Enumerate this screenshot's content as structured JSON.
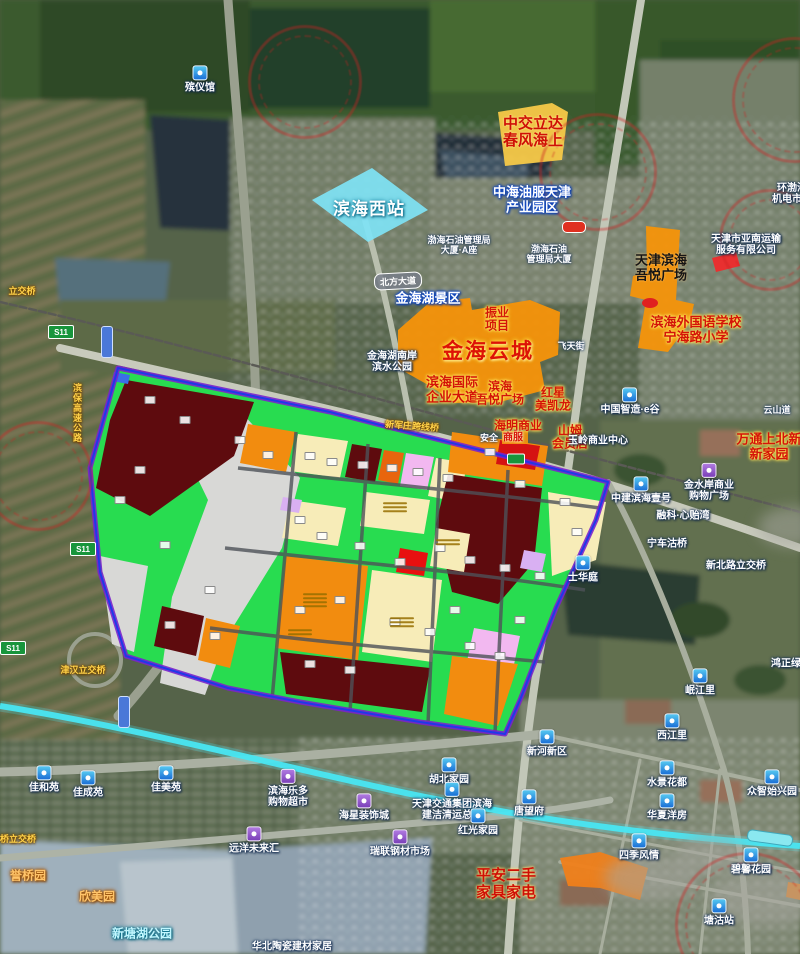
{
  "map": {
    "region_name": "天津滨海新区 金海云城周边卫星规划图",
    "colors": {
      "zone_maroon": "#5E0B0E",
      "zone_green": "#28DC50",
      "zone_orange": "#F28C0F",
      "zone_cream": "#F7ECB8",
      "zone_pink": "#F2B8F0",
      "zone_red": "#E01212",
      "zone_gray": "#D8D8D6",
      "boundary_purple": "#7A22CC",
      "boundary_blue": "#2038E8",
      "landmark_orange": "#F5930A",
      "station_cyan": "#7FE3F5",
      "water_cyan": "#49E6F2",
      "highlight_yellow": "#F7C948",
      "watermark_red": "#CD2323"
    },
    "labels": [
      {
        "t": "殡仪馆",
        "x": 200,
        "y": 88,
        "s": "s-white-sm",
        "i": "blue"
      },
      {
        "t": "中交立达\n春风海上",
        "x": 533,
        "y": 133,
        "s": "s-red-lg"
      },
      {
        "t": "滨海西站",
        "x": 369,
        "y": 209,
        "s": "s-station"
      },
      {
        "t": "中海油服天津\n产业园区",
        "x": 532,
        "y": 200,
        "s": "s-blueoutline"
      },
      {
        "t": "渤海石油管理局\n大厦·A座",
        "x": 459,
        "y": 245,
        "s": "s-white-xs"
      },
      {
        "t": "渤海石油\n管理局大厦",
        "x": 549,
        "y": 254,
        "s": "s-white-xs"
      },
      {
        "t": "天津滨海\n吾悦广场",
        "x": 661,
        "y": 268,
        "s": "s-black"
      },
      {
        "t": "天津市亚南运输\n服务有限公司",
        "x": 746,
        "y": 245,
        "s": "s-white-sm"
      },
      {
        "t": "环渤海\n机电市场",
        "x": 792,
        "y": 194,
        "s": "s-white-sm"
      },
      {
        "t": "滨海外国语学校\n宁海路小学",
        "x": 696,
        "y": 330,
        "s": "s-redglow-lg"
      },
      {
        "t": "金海湖景区",
        "x": 428,
        "y": 299,
        "s": "s-blueoutline"
      },
      {
        "t": "金海湖南岸\n滨水公园",
        "x": 392,
        "y": 362,
        "s": "s-white-sm"
      },
      {
        "t": "振业\n项目",
        "x": 497,
        "y": 320,
        "s": "s-redglow"
      },
      {
        "t": "金海云城",
        "x": 488,
        "y": 352,
        "s": "s-bigred"
      },
      {
        "t": "飞天街",
        "x": 571,
        "y": 346,
        "s": "s-white-xs"
      },
      {
        "t": "滨海国际\n企业大道",
        "x": 452,
        "y": 390,
        "s": "s-redglow-lg"
      },
      {
        "t": "滨海\n吾悦广场",
        "x": 500,
        "y": 394,
        "s": "s-redglow"
      },
      {
        "t": "红星\n美凯龙",
        "x": 553,
        "y": 400,
        "s": "s-redglow"
      },
      {
        "t": "海明商业",
        "x": 518,
        "y": 426,
        "s": "s-redglow"
      },
      {
        "t": "安全",
        "x": 489,
        "y": 438,
        "s": "s-white-xs"
      },
      {
        "t": "商服",
        "x": 513,
        "y": 438,
        "s": "s-red"
      },
      {
        "t": "山姆\n会员店",
        "x": 570,
        "y": 438,
        "s": "s-redglow"
      },
      {
        "t": "玉岭商业中心",
        "x": 598,
        "y": 441,
        "s": "s-white-sm"
      },
      {
        "t": "中国智造·e谷",
        "x": 630,
        "y": 410,
        "s": "s-white-sm",
        "i": "blue"
      },
      {
        "t": "云山道",
        "x": 777,
        "y": 410,
        "s": "s-white-xs"
      },
      {
        "t": "万通上北新\n新家园",
        "x": 769,
        "y": 447,
        "s": "s-redglow-lg"
      },
      {
        "t": "金水岸商业\n购物广场",
        "x": 709,
        "y": 491,
        "s": "s-white-sm",
        "i": "purple"
      },
      {
        "t": "中建滨海壹号",
        "x": 641,
        "y": 499,
        "s": "s-white-sm",
        "i": "blue"
      },
      {
        "t": "融科·心贻湾",
        "x": 683,
        "y": 516,
        "s": "s-white-sm"
      },
      {
        "t": "宁车沽桥",
        "x": 667,
        "y": 544,
        "s": "s-white-sm"
      },
      {
        "t": "新北路立交桥",
        "x": 736,
        "y": 566,
        "s": "s-white-sm"
      },
      {
        "t": "士华庭",
        "x": 583,
        "y": 578,
        "s": "s-white-sm",
        "i": "blue"
      },
      {
        "t": "鸿正绿色",
        "x": 791,
        "y": 664,
        "s": "s-white-sm"
      },
      {
        "t": "岷江里",
        "x": 700,
        "y": 691,
        "s": "s-white-sm",
        "i": "blue"
      },
      {
        "t": "西江里",
        "x": 672,
        "y": 736,
        "s": "s-white-sm",
        "i": "blue"
      },
      {
        "t": "新河新区",
        "x": 547,
        "y": 752,
        "s": "s-white-sm",
        "i": "blue"
      },
      {
        "t": "胡北家园",
        "x": 449,
        "y": 780,
        "s": "s-white-sm",
        "i": "blue"
      },
      {
        "t": "水景花都",
        "x": 667,
        "y": 783,
        "s": "s-white-sm",
        "i": "blue"
      },
      {
        "t": "众智始兴园",
        "x": 772,
        "y": 792,
        "s": "s-white-sm",
        "i": "blue"
      },
      {
        "t": "唐望府",
        "x": 529,
        "y": 812,
        "s": "s-white-sm",
        "i": "blue"
      },
      {
        "t": "华夏洋房",
        "x": 667,
        "y": 816,
        "s": "s-white-sm",
        "i": "blue"
      },
      {
        "t": "四季风情",
        "x": 639,
        "y": 856,
        "s": "s-white-sm",
        "i": "blue"
      },
      {
        "t": "碧馨花园",
        "x": 751,
        "y": 870,
        "s": "s-white-sm",
        "i": "blue"
      },
      {
        "t": "塘沽站",
        "x": 719,
        "y": 921,
        "s": "s-white-sm",
        "i": "blue"
      },
      {
        "t": "滨海乐多\n购物超市",
        "x": 288,
        "y": 797,
        "s": "s-white-sm",
        "i": "purple"
      },
      {
        "t": "海星装饰城",
        "x": 364,
        "y": 816,
        "s": "s-white-sm",
        "i": "purple"
      },
      {
        "t": "天津交通集团滨海\n建洁清运总站",
        "x": 452,
        "y": 810,
        "s": "s-white-sm",
        "i": "blue"
      },
      {
        "t": "红光家园",
        "x": 478,
        "y": 831,
        "s": "s-white-sm",
        "i": "blue"
      },
      {
        "t": "瑞联钢材市场",
        "x": 400,
        "y": 852,
        "s": "s-white-sm",
        "i": "purple"
      },
      {
        "t": "远洋未来汇",
        "x": 254,
        "y": 849,
        "s": "s-white-sm",
        "i": "purple"
      },
      {
        "t": "佳和苑",
        "x": 44,
        "y": 788,
        "s": "s-white-sm",
        "i": "blue"
      },
      {
        "t": "佳成苑",
        "x": 88,
        "y": 793,
        "s": "s-white-sm",
        "i": "blue"
      },
      {
        "t": "佳美苑",
        "x": 166,
        "y": 788,
        "s": "s-white-sm",
        "i": "blue"
      },
      {
        "t": "平安二手\n家具家电",
        "x": 506,
        "y": 885,
        "s": "s-red-lg"
      },
      {
        "t": "华北陶瓷建材家居",
        "x": 292,
        "y": 947,
        "s": "s-white-sm"
      },
      {
        "t": "新军庄跨线桥",
        "x": 412,
        "y": 426,
        "s": "s-road",
        "r": 4
      },
      {
        "t": "立交桥",
        "x": 22,
        "y": 291,
        "s": "s-road"
      },
      {
        "t": "津汉立交桥",
        "x": 83,
        "y": 670,
        "s": "s-road"
      },
      {
        "t": "桥立交桥",
        "x": 18,
        "y": 839,
        "s": "s-road"
      },
      {
        "t": "滨保高速公路",
        "x": 77,
        "y": 413,
        "s": "s-road",
        "v": true
      },
      {
        "t": "誉桥园",
        "x": 28,
        "y": 876,
        "s": "s-orangearea"
      },
      {
        "t": "欣美园",
        "x": 97,
        "y": 897,
        "s": "s-orangearea"
      },
      {
        "t": "新塘湖公园",
        "x": 142,
        "y": 934,
        "s": "s-cyanpark"
      }
    ],
    "road_badges": [
      {
        "t": "S11",
        "x": 61,
        "y": 332,
        "k": "b-green"
      },
      {
        "t": "S11",
        "x": 83,
        "y": 549,
        "k": "b-green"
      },
      {
        "t": "S11",
        "x": 13,
        "y": 648,
        "k": "b-green"
      },
      {
        "t": "",
        "x": 574,
        "y": 227,
        "k": "b-red"
      },
      {
        "t": "",
        "x": 516,
        "y": 459,
        "k": "b-green-sm"
      },
      {
        "t": "北方大道",
        "x": 398,
        "y": 281,
        "k": "b-gray",
        "r": -3
      },
      {
        "t": "",
        "x": 770,
        "y": 838,
        "k": "b-cyan",
        "r": 8
      },
      {
        "t": "",
        "x": 107,
        "y": 342,
        "k": "b-bluev"
      },
      {
        "t": "",
        "x": 124,
        "y": 712,
        "k": "b-bluev"
      }
    ],
    "watermark_rings": [
      {
        "x": 305,
        "y": 82,
        "d": 108
      },
      {
        "x": 598,
        "y": 172,
        "d": 112
      },
      {
        "x": 795,
        "y": 100,
        "d": 120
      },
      {
        "x": 38,
        "y": 476,
        "d": 104
      },
      {
        "x": 770,
        "y": 240,
        "d": 96
      },
      {
        "x": 748,
        "y": 925,
        "d": 140
      }
    ],
    "cloud_blobs": [
      {
        "x": 652,
        "y": 878,
        "w": 95,
        "h": 48
      },
      {
        "x": 768,
        "y": 898,
        "w": 120,
        "h": 55
      },
      {
        "x": 793,
        "y": 527,
        "w": 70,
        "h": 40
      },
      {
        "x": 710,
        "y": 855,
        "w": 70,
        "h": 38
      }
    ],
    "zone_chips": [
      [
        150,
        400
      ],
      [
        185,
        420
      ],
      [
        240,
        440
      ],
      [
        268,
        455
      ],
      [
        310,
        456
      ],
      [
        332,
        462
      ],
      [
        363,
        465
      ],
      [
        392,
        468
      ],
      [
        418,
        472
      ],
      [
        448,
        478
      ],
      [
        490,
        452
      ],
      [
        520,
        484
      ],
      [
        565,
        502
      ],
      [
        577,
        532
      ],
      [
        300,
        520
      ],
      [
        322,
        536
      ],
      [
        360,
        546
      ],
      [
        400,
        562
      ],
      [
        440,
        548
      ],
      [
        470,
        560
      ],
      [
        505,
        568
      ],
      [
        540,
        576
      ],
      [
        170,
        625
      ],
      [
        215,
        636
      ],
      [
        300,
        610
      ],
      [
        340,
        600
      ],
      [
        395,
        622
      ],
      [
        430,
        632
      ],
      [
        470,
        646
      ],
      [
        500,
        656
      ],
      [
        350,
        670
      ],
      [
        310,
        664
      ],
      [
        210,
        590
      ],
      [
        140,
        470
      ],
      [
        120,
        500
      ],
      [
        165,
        545
      ],
      [
        455,
        610
      ],
      [
        520,
        620
      ]
    ],
    "zone_text_marks": [
      {
        "x": 395,
        "y": 507,
        "n": 3
      },
      {
        "x": 315,
        "y": 600,
        "n": 4
      },
      {
        "x": 402,
        "y": 622,
        "n": 3
      },
      {
        "x": 300,
        "y": 632,
        "n": 2
      },
      {
        "x": 448,
        "y": 542,
        "n": 2
      }
    ]
  }
}
